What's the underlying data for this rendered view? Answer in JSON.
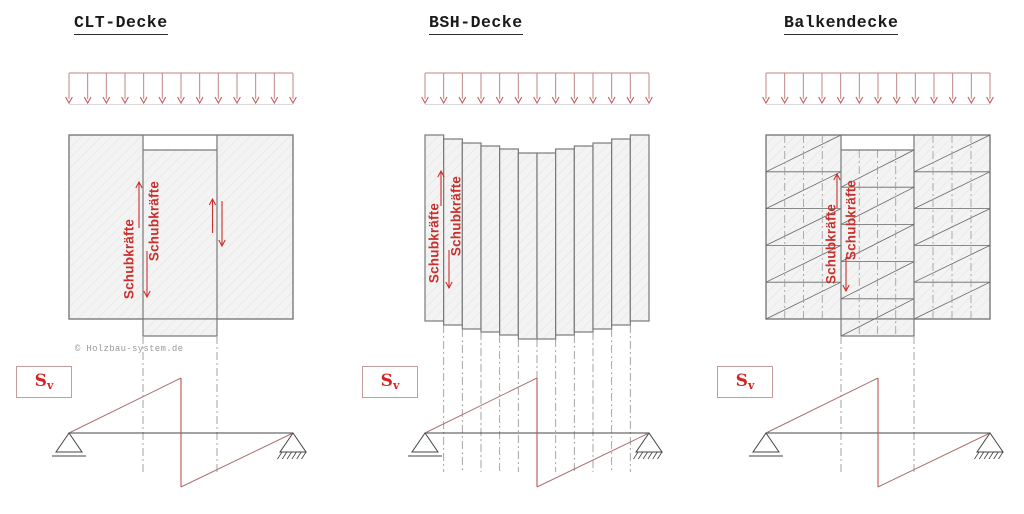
{
  "figures": [
    {
      "id": "clt",
      "title": "CLT-Decke"
    },
    {
      "id": "bsh",
      "title": "BSH-Decke"
    },
    {
      "id": "balken",
      "title": "Balkendecke"
    }
  ],
  "labels": {
    "shear_forces": "Schubkräfte",
    "sv_base": "S",
    "sv_sub": "v"
  },
  "copyright": "© Holzbau-system.de",
  "diagram_semantics": {
    "load": "uniform distributed load arrows over each slab",
    "shear_plot": "shear force diagram Sv: rises from left support to midspan, jumps down, rises to right support",
    "clt": "solid cross-laminated slab with one vertical strip displaced downward",
    "bsh": "12 glulam boards each slipping progressively downward toward midspan",
    "balken": "beam deck of three sections with board rows, diagonals and displaced middle strip"
  },
  "colors": {
    "accent_red": "#c9302c",
    "load_arrow_stem": "#c08585",
    "load_arrow_head": "#c75b5b",
    "load_base": "#d9d9d9",
    "shear_line": "#ab7272",
    "shear_drop": "#c05252",
    "outline": "#444444",
    "panel_border": "#7a7a7a",
    "panel_fill": "#f3f3f3",
    "hatch_line": "#e2e2e2",
    "guide": "#9a9a9a",
    "row_line": "#666666"
  }
}
